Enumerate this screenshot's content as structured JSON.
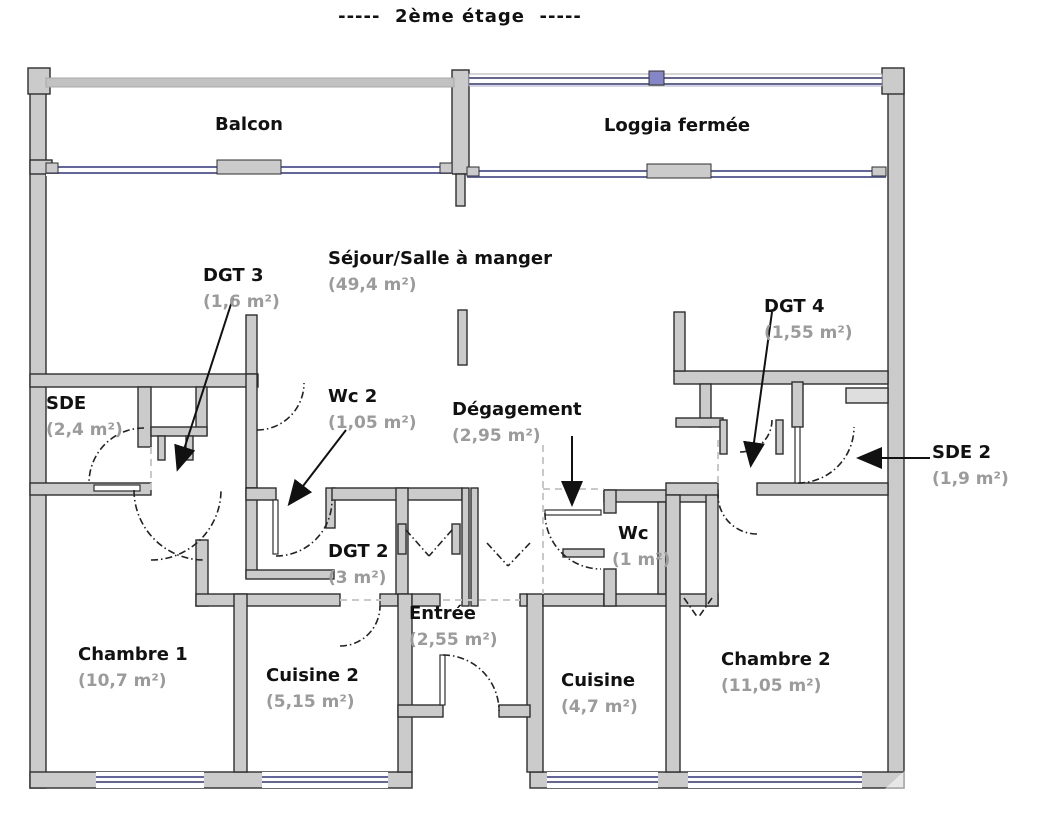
{
  "title": "-----  2ème étage  -----",
  "colors": {
    "wall_fill": "#cbcbcb",
    "wall_stroke": "#2e2e2e",
    "window_blue": "#6164a8",
    "room_name_text": "#111111",
    "room_area_text": "#9b9b9b"
  },
  "rooms": {
    "balcon": {
      "name": "Balcon"
    },
    "loggia": {
      "name": "Loggia fermée"
    },
    "sejour": {
      "name": "Séjour/Salle à manger",
      "area": "(49,4 m²)"
    },
    "dgt3": {
      "name": "DGT 3",
      "area": "(1,6 m²)"
    },
    "sde": {
      "name": "SDE",
      "area": "(2,4 m²)"
    },
    "wc2": {
      "name": "Wc 2",
      "area": "(1,05 m²)"
    },
    "degagement": {
      "name": "Dégagement",
      "area": "(2,95 m²)"
    },
    "dgt4": {
      "name": "DGT 4",
      "area": "(1,55 m²)"
    },
    "sde2": {
      "name": "SDE 2",
      "area": "(1,9 m²)"
    },
    "dgt2": {
      "name": "DGT 2",
      "area": "(3 m²)"
    },
    "wc": {
      "name": "Wc",
      "area": "(1 m²)"
    },
    "chambre1": {
      "name": "Chambre 1",
      "area": "(10,7 m²)"
    },
    "cuisine2": {
      "name": "Cuisine 2",
      "area": "(5,15 m²)"
    },
    "entree": {
      "name": "Entrée",
      "area": "(2,55 m²)"
    },
    "cuisine": {
      "name": "Cuisine",
      "area": "(4,7 m²)"
    },
    "chambre2": {
      "name": "Chambre 2",
      "area": "(11,05 m²)"
    }
  }
}
